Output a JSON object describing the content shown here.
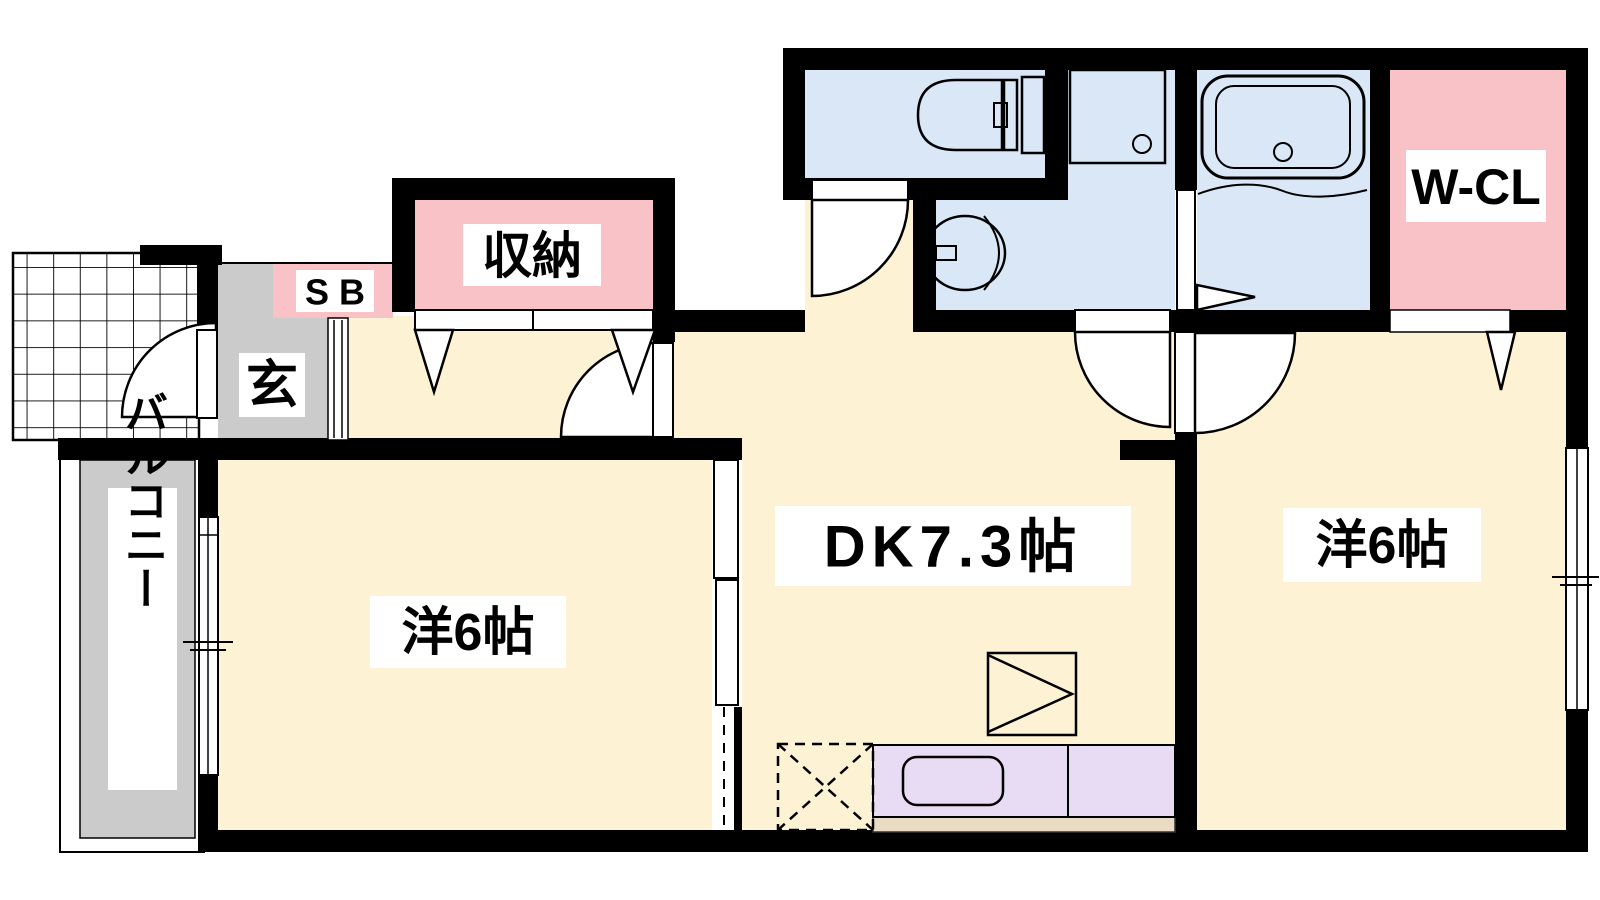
{
  "plan_type": "floorplan",
  "colors": {
    "wall": "#000000",
    "floor_cream": "#fdf2d4",
    "closet_pink": "#f9c2c6",
    "wet_area_blue": "#d9e7f7",
    "entry_gray": "#cbcbcb",
    "counter_purple": "#e7dcf3",
    "counter_edge_tan": "#e9dcc3",
    "label_bg": "#ffffff",
    "outline": "#000000"
  },
  "rooms": {
    "balcony": {
      "label": "バルコニー"
    },
    "entry": {
      "label": "玄"
    },
    "shoe_box": {
      "label": "SB"
    },
    "storage": {
      "label": "収納"
    },
    "western_left": {
      "label": "洋6帖"
    },
    "dining_kitchen": {
      "label": "DK7.3帖"
    },
    "western_right": {
      "label": "洋6帖"
    },
    "walk_in_closet": {
      "label": "W-CL"
    }
  },
  "fixtures": {
    "toilet": "toilet-symbol",
    "wash_basin": "sink-symbol",
    "washer_pan": "washer-pan-symbol",
    "bathtub": "bathtub-symbol",
    "kitchen_counter": "kitchen-counter-symbol",
    "kitchen_sink": "kitchen-sink-symbol",
    "refrigerator": "refrigerator-symbol",
    "appliance_space": "dashed-appliance-space-symbol"
  }
}
